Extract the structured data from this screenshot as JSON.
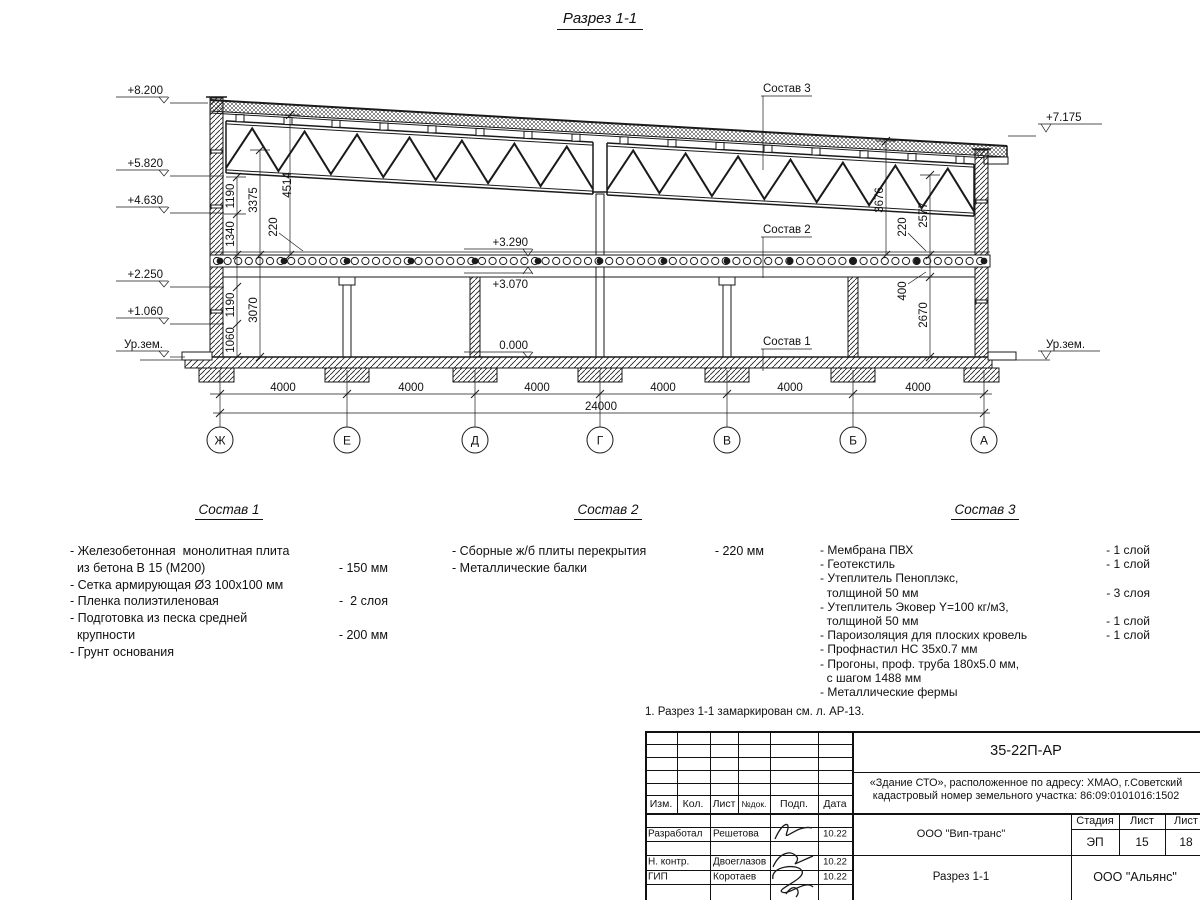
{
  "page": {
    "title": "Разрез 1-1",
    "note": "1. Разрез 1-1 замаркирован см. л. АР-13."
  },
  "drawing": {
    "elevations_left": [
      "+8.200",
      "+5.820",
      "+4.630",
      "+2.250",
      "+1.060",
      "Ур.зем."
    ],
    "elevation_right_top": "+7.175",
    "elevation_right_ground": "Ур.зем.",
    "mid_levels": [
      "+3.290",
      "+3.070",
      "0.000"
    ],
    "layer_labels": [
      "Состав 3",
      "Состав 2",
      "Состав 1"
    ],
    "dims_left": [
      "1190",
      "1340",
      "3375",
      "220",
      "4514",
      "1190",
      "1060",
      "3070"
    ],
    "dims_right": [
      "3676",
      "220",
      "2577",
      "400",
      "2670"
    ],
    "span_dims": [
      "4000",
      "4000",
      "4000",
      "4000",
      "4000",
      "4000"
    ],
    "total_dim": "24000",
    "axis_labels": [
      "Ж",
      "Е",
      "Д",
      "Г",
      "В",
      "Б",
      "А"
    ]
  },
  "compositions": [
    {
      "title": "Состав 1",
      "lines": [
        {
          "t": "- Железобетонная  монолитная плита",
          "v": ""
        },
        {
          "t": "  из бетона В 15 (М200)",
          "v": "- 150 мм"
        },
        {
          "t": "- Сетка армирующая Ø3 100х100 мм",
          "v": ""
        },
        {
          "t": "- Пленка полиэтиленовая",
          "v": "-  2 слоя"
        },
        {
          "t": "- Подготовка из песка средней",
          "v": ""
        },
        {
          "t": "  крупности",
          "v": "- 200 мм"
        },
        {
          "t": "- Грунт основания",
          "v": ""
        }
      ]
    },
    {
      "title": "Состав 2",
      "lines": [
        {
          "t": "- Сборные ж/б плиты перекрытия",
          "v": "- 220 мм"
        },
        {
          "t": "- Металлические балки",
          "v": ""
        }
      ]
    },
    {
      "title": "Состав 3",
      "lines": [
        {
          "t": "- Мембрана ПВХ",
          "v": "- 1 слой"
        },
        {
          "t": "- Геотекстиль",
          "v": "- 1 слой"
        },
        {
          "t": "- Утеплитель Пеноплэкс,",
          "v": ""
        },
        {
          "t": "  толщиной 50 мм",
          "v": "- 3 слоя"
        },
        {
          "t": "- Утеплитель Эковер Y=100 кг/м3,",
          "v": ""
        },
        {
          "t": "  толщиной 50 мм",
          "v": "- 1 слой"
        },
        {
          "t": "- Пароизоляция для плоских кровель",
          "v": "- 1 слой"
        },
        {
          "t": "- Профнастил НС 35х0.7 мм",
          "v": ""
        },
        {
          "t": "- Прогоны, проф. труба 180х5.0 мм,",
          "v": ""
        },
        {
          "t": "  с шагом 1488 мм",
          "v": ""
        },
        {
          "t": "- Металлические фермы",
          "v": ""
        }
      ]
    }
  ],
  "titleblock": {
    "doc_number": "35-22П-АР",
    "desc1": "«Здание СТО», расположенное по адресу: ХМАО, г.Советский",
    "desc2": "кадастровый номер земельного участка: 86:09:0101016:1502",
    "cols": [
      "Изм.",
      "Кол.",
      "Лист",
      "№док.",
      "Подп.",
      "Дата"
    ],
    "rows": [
      {
        "role": "Разработал",
        "name": "Решетова",
        "date": "10.22"
      },
      {
        "role": "Н. контр.",
        "name": "Двоеглазов",
        "date": "10.22"
      },
      {
        "role": "ГИП",
        "name": "Коротаев",
        "date": "10.22"
      }
    ],
    "org_center": "ООО \"Вип-транс\"",
    "sheet_title": "Разрез 1-1",
    "org_right": "ООО \"Альянс\"",
    "stage_label": "Стадия",
    "sheet_label": "Лист",
    "sheets_label": "Лист",
    "stage": "ЭП",
    "sheet": "15",
    "sheets": "18"
  }
}
